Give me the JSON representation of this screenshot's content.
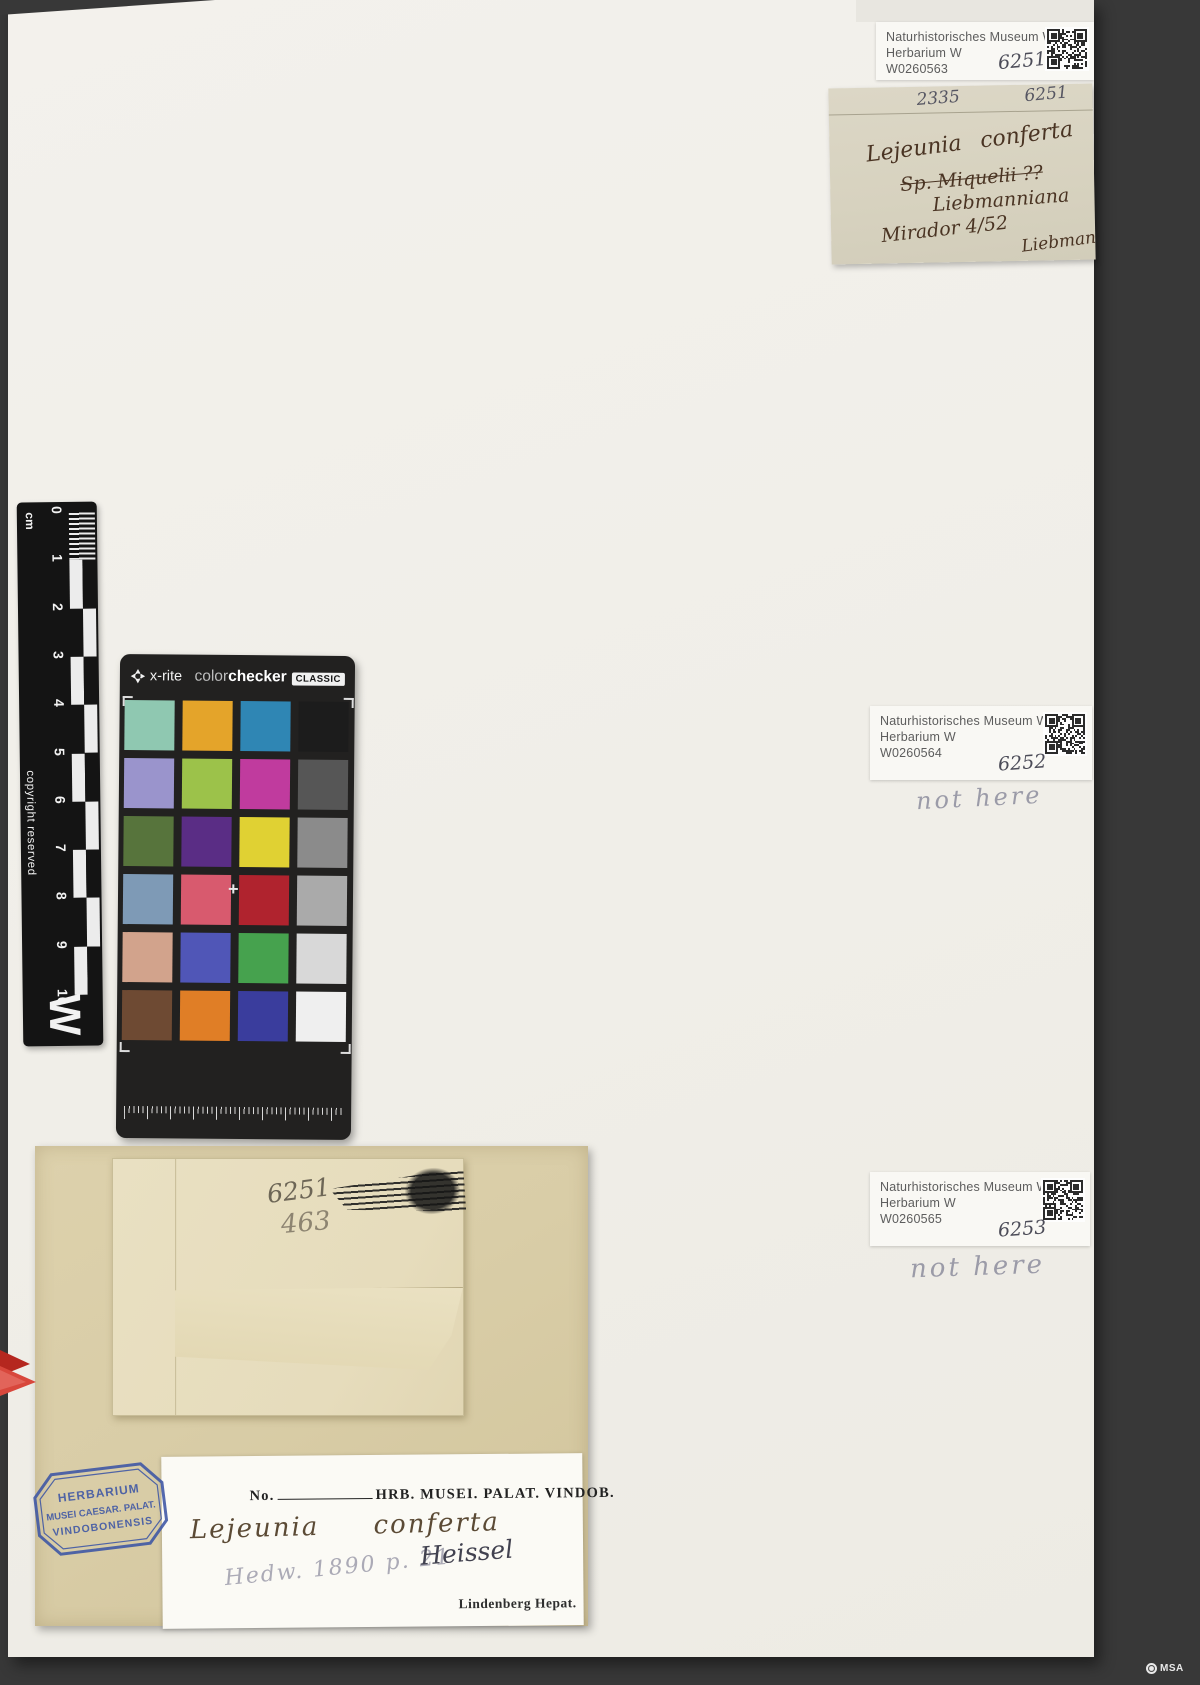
{
  "colors": {
    "mat": "#383838",
    "sheet": "#f2f0ea",
    "old_label_paper": "#d8d3c1",
    "folder_paper": "#daceA8",
    "stamp_blue": "#3c55a5",
    "clip_red": "#c0352a"
  },
  "museum_labels": [
    {
      "museum": "Naturhistorisches Museum Wien",
      "herbarium": "Herbarium W",
      "barcode": "W0260563",
      "number": "6251",
      "note": ""
    },
    {
      "museum": "Naturhistorisches Museum Wien",
      "herbarium": "Herbarium W",
      "barcode": "W0260564",
      "number": "6252",
      "note": "not here"
    },
    {
      "museum": "Naturhistorisches Museum Wien",
      "herbarium": "Herbarium W",
      "barcode": "W0260565",
      "number": "6253",
      "note": "not here"
    }
  ],
  "old_label": {
    "pencil_left": "2335",
    "pencil_right": "6251",
    "species": "Lejeunia conferta",
    "struck_line": "Sp. Miquelii ??",
    "variety": "Liebmanniana",
    "locality": "Mirador 4/52",
    "collector": "Liebman"
  },
  "ruler": {
    "unit": "cm",
    "numbers": [
      "0",
      "1",
      "2",
      "3",
      "4",
      "5",
      "6",
      "7",
      "8",
      "9",
      "10"
    ],
    "copyright": "copyright reserved",
    "letter": "W"
  },
  "colorchecker": {
    "brand": "x-rite",
    "product_light": "color",
    "product_bold": "checker",
    "variant": "CLASSIC",
    "cross": "+",
    "grid": {
      "rows": 6,
      "cols": 4
    },
    "patches": [
      "#8fc8b1",
      "#e4a42a",
      "#2f86b4",
      "#1c1c1c",
      "#9a94cc",
      "#9cc24a",
      "#c03b9e",
      "#565656",
      "#57743c",
      "#5a2d85",
      "#e0d133",
      "#8b8b8b",
      "#7e9ab6",
      "#d85a6e",
      "#b0232e",
      "#aaaaaa",
      "#d2a38c",
      "#5056b7",
      "#46a24e",
      "#d8d8d8",
      "#6e4a33",
      "#e07e26",
      "#3a3d9d",
      "#efefef"
    ]
  },
  "envelope": {
    "pencil_number": "6251",
    "pencil_number_2": "463"
  },
  "packet_label": {
    "no_label": "No.",
    "header": "HRB. MUSEI. PALAT. VINDOB.",
    "species": "Lejeunia conferta",
    "citation": "Hedw. 1890 p. 21",
    "determiner": "Heissel",
    "series": "Lindenberg Hepat."
  },
  "stamp": {
    "line1": "HERBARIUM",
    "line2": "MUSEI CAESAR. PALAT.",
    "line3": "VINDOBONENSIS"
  },
  "footer": {
    "logo_text": "MSA"
  }
}
